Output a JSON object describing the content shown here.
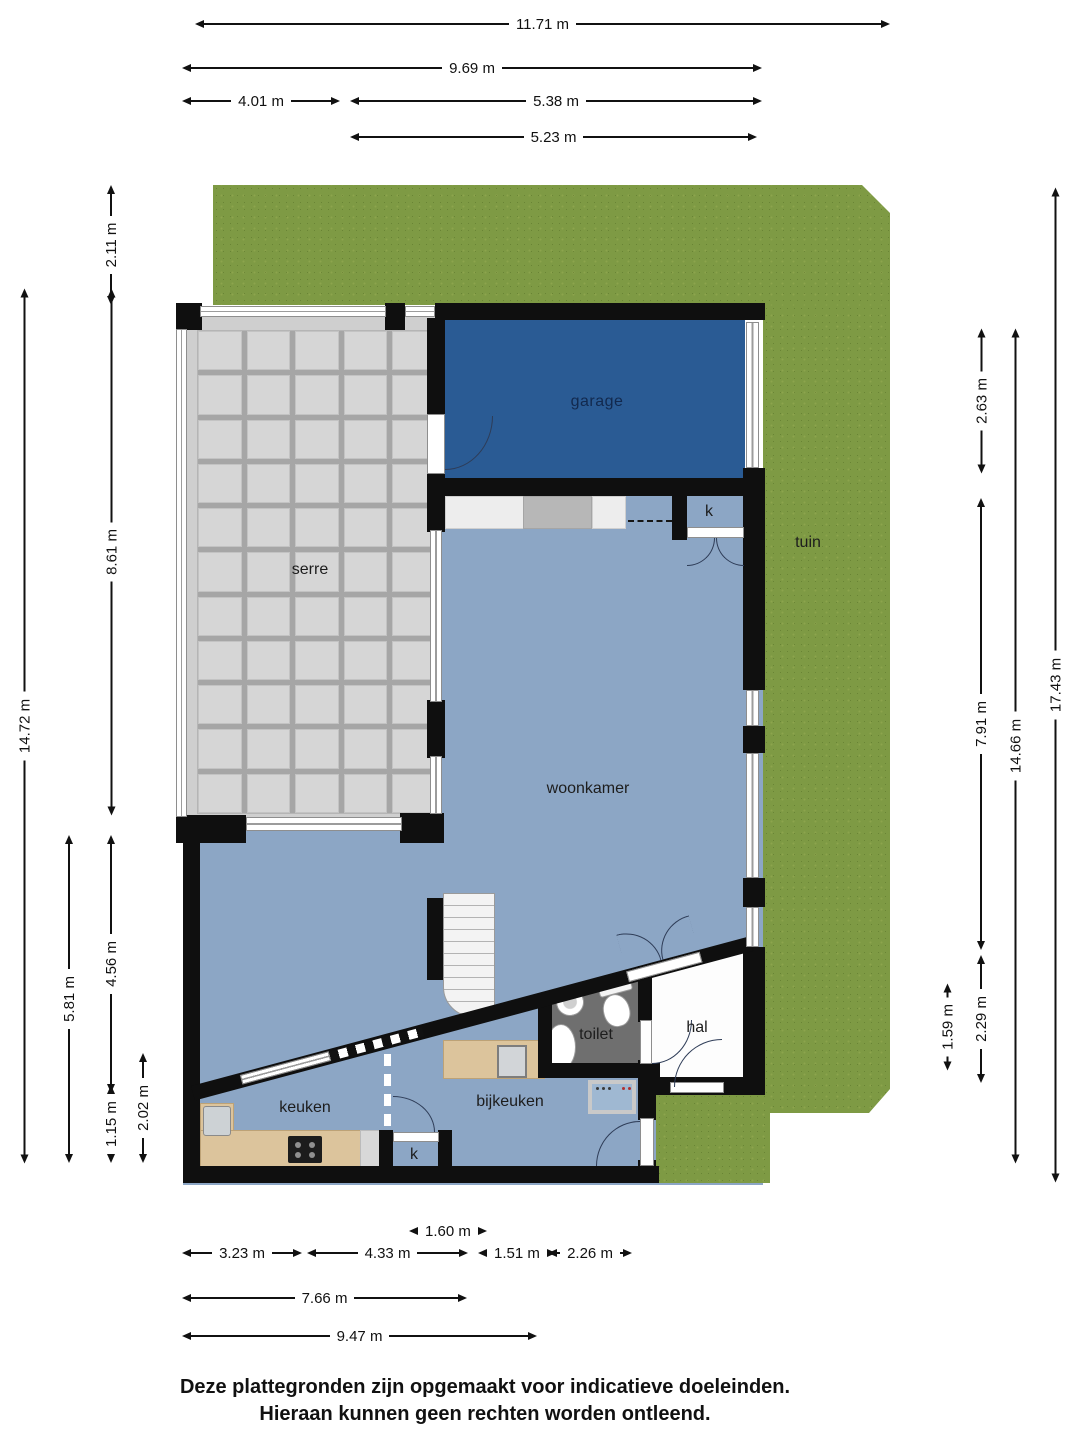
{
  "rooms": {
    "garage": "garage",
    "serre": "serre",
    "tuin": "tuin",
    "woonkamer": "woonkamer",
    "keuken": "keuken",
    "bijkeuken": "bijkeuken",
    "toilet": "toilet",
    "hal": "hal",
    "closet_top": "k",
    "closet_bottom": "k"
  },
  "dims": {
    "top": [
      "11.71 m",
      "9.69 m",
      "4.01 m",
      "5.38 m",
      "5.23 m"
    ],
    "left": [
      "2.11 m",
      "8.61 m",
      "14.72 m",
      "4.56 m",
      "5.81 m",
      "1.15 m",
      "2.02 m"
    ],
    "right": [
      "2.63 m",
      "7.91 m",
      "14.66 m",
      "17.43 m",
      "1.59 m",
      "2.29 m"
    ],
    "bottom": [
      "1.60 m",
      "3.23 m",
      "4.33 m",
      "1.51 m",
      "2.26 m",
      "7.66 m",
      "9.47 m"
    ]
  },
  "footer": {
    "line1": "Deze plattegronden zijn opgemaakt voor indicatieve doeleinden.",
    "line2": "Hieraan kunnen geen rechten worden ontleend."
  },
  "colors": {
    "grass": "#7e9a44",
    "garage_floor": "#2a5b94",
    "living_floor": "#8ca6c5",
    "toilet_floor": "#6f6f6f",
    "hall_floor": "#fdfdfd",
    "wall": "#0f0f0f",
    "counter_wood": "#dcc49c",
    "serre_panel": "#d6d6d6"
  }
}
